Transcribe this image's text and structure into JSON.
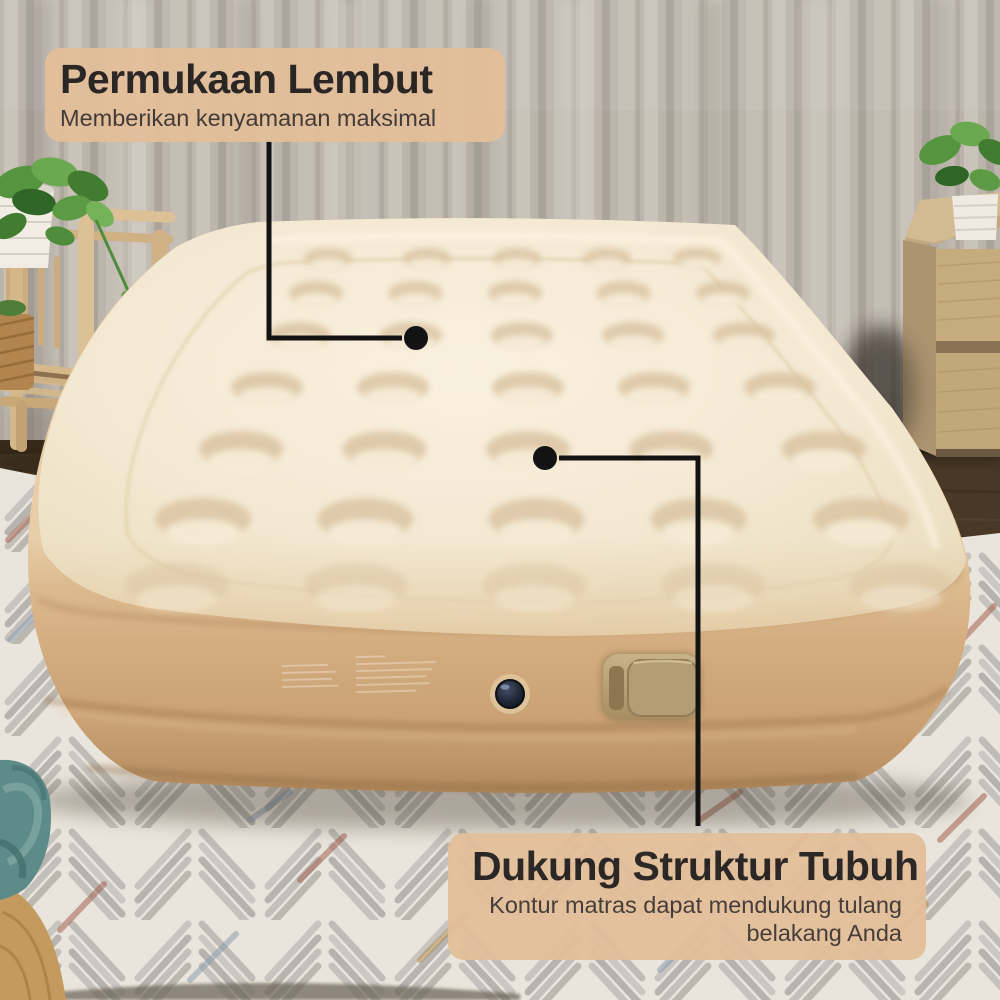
{
  "callouts": {
    "soft_surface": {
      "title": "Permukaan Lembut",
      "subtitle": "Memberikan kenyamanan maksimal"
    },
    "body_support": {
      "title": "Dukung Struktur Tubuh",
      "subtitle": "Kontur matras dapat mendukung tulang belakang Anda"
    }
  },
  "colors": {
    "callout_bg": "#e4bf9a",
    "callout_title": "#211d1c",
    "callout_subtitle": "#3c3431",
    "callout_line": "#131313",
    "mattress_top": "#f5ebd7",
    "mattress_side": "#d2a97c",
    "curtain": "#bcb5ac",
    "wood_floor": "#4a3827",
    "rug_base": "#eae5dc",
    "rug_accent_rust": "#a26250",
    "rug_accent_blue": "#8a9cae",
    "teal_blanket": "#5d8b88",
    "nightstand_wood": "#c6ab7e",
    "plant_green": "#4c8a3e"
  }
}
